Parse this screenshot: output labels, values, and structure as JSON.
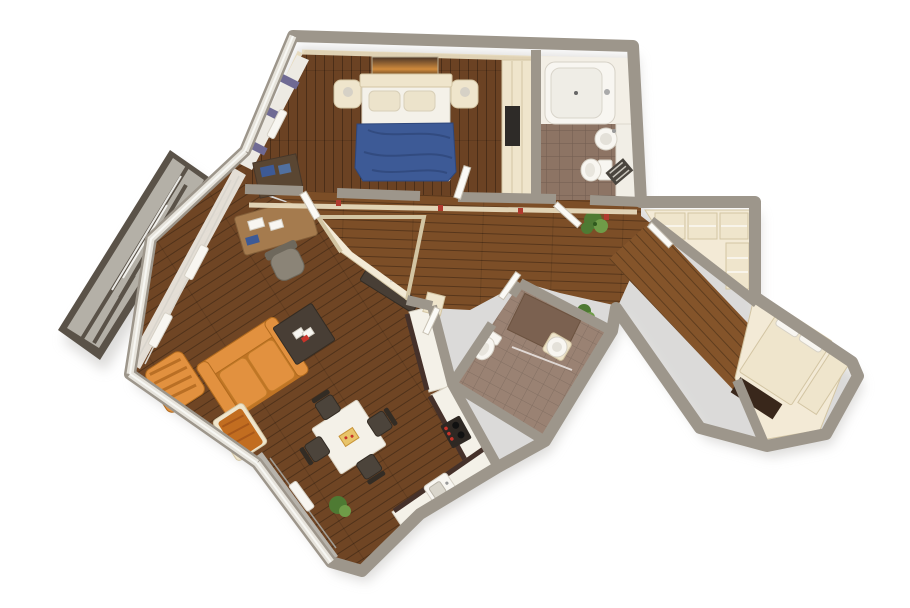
{
  "scene": {
    "description": "3D rendered top-down floor plan of an apartment, white background, no text",
    "background": "#ffffff"
  },
  "colors": {
    "background": "#ffffff",
    "shadow": "#d8d7d5",
    "wall": "#9d968b",
    "wallFace": "#e7dabd",
    "windowBand": "#e6e3db",
    "windowLine": "#f8f8f5",
    "woodBedroom": "#6b4223",
    "woodHall": "#7c4e27",
    "woodLiving": "#6f4524",
    "woodCorridor": "#84542a",
    "tileBath": "#8d7464",
    "tileShower": "#9a8273",
    "showerTray": "#7b6150",
    "cream": "#efe5cc",
    "creamEdge": "#d3c5a3",
    "floorCream": "#f3ead6",
    "fixtureWhite": "#f8f6f1",
    "fixtureShade": "#d6d1c6",
    "bedFrame": "#f4f1e9",
    "pillow": "#ece3cb",
    "blanket": "#3d5a96",
    "blanketFold": "#2f477b",
    "sofa": "#e2913f",
    "sofaDark": "#c07424",
    "throw": "#c26d20",
    "tableDark": "#483e35",
    "chairGrey": "#4c443b",
    "desk": "#a57b4e",
    "officeChair": "#8b8477",
    "curtainWhite": "#edeae3",
    "curtainGrey": "#b7b3ab",
    "curtainPurple": "#6f6a94",
    "counterWhite": "#f4f1e8",
    "cabinetDark": "#45312a",
    "stoveDark": "#2e2823",
    "knobRed": "#c8332a",
    "balconyFrame": "#5a5248",
    "balconyGlass": "#b4b0a7",
    "plant": "#4e7a33",
    "plantLight": "#6f9c48",
    "doorWhite": "#fbfaf6",
    "doorEdge": "#c9c2b4",
    "rug": "#39271b",
    "switchRed": "#b03a2e",
    "pictureTop": "#4a3527",
    "pictureMid": "#d08a3c",
    "pictureBot": "#2f2418"
  },
  "rooms": [
    {
      "name": "bedroom",
      "floor": "dark wood planks",
      "furniture": [
        "double-bed",
        "blue-blanket",
        "pillow-left",
        "pillow-right",
        "headboard",
        "nightstand-left",
        "nightstand-right",
        "lamp-left",
        "lamp-right",
        "sunset-picture",
        "wardrobe",
        "striped-curtains",
        "radiator",
        "dresser-with-books",
        "door"
      ]
    },
    {
      "name": "bathroom",
      "floor": "brown tile",
      "furniture": [
        "bathtub",
        "washbasin",
        "toilet",
        "towel-radiator",
        "side-shelf"
      ]
    },
    {
      "name": "hallway",
      "floor": "wood planks",
      "furniture": [
        "potted-plant",
        "open-doors",
        "wall-switches"
      ]
    },
    {
      "name": "entry-nook",
      "floor": "cream tile",
      "furniture": [
        "shelving"
      ]
    },
    {
      "name": "living-room",
      "floor": "wood planks",
      "furniture": [
        "corner-desk",
        "office-chair",
        "orange-sofa",
        "coffee-table-with-cards",
        "armchair",
        "lounge-chair-with-throw",
        "sideboard",
        "white-curtains",
        "radiators"
      ]
    },
    {
      "name": "kitchen-dining",
      "floor": "wood planks",
      "furniture": [
        "dining-table",
        "chair-1",
        "chair-2",
        "chair-3",
        "chair-4",
        "kitchen-counter",
        "stove-with-red-knobs",
        "kitchen-sink",
        "tall-cabinet",
        "grey-curtains",
        "plant",
        "radiator"
      ]
    },
    {
      "name": "shower-room",
      "floor": "tile",
      "furniture": [
        "shower-tray",
        "toilet",
        "washbasin",
        "plant"
      ]
    },
    {
      "name": "walk-in-closet",
      "floor": "cream",
      "furniture": [
        "shelf-unit-1",
        "shelf-unit-2",
        "shelf-unit-3",
        "side-unit"
      ]
    },
    {
      "name": "corridor",
      "floor": "wood planks",
      "furniture": []
    },
    {
      "name": "guest-room",
      "floor": "cream",
      "furniture": [
        "bed",
        "side-cabinet",
        "dark-rug"
      ]
    },
    {
      "name": "balcony",
      "floor": "concrete",
      "furniture": [
        "glazing-panels"
      ]
    }
  ]
}
